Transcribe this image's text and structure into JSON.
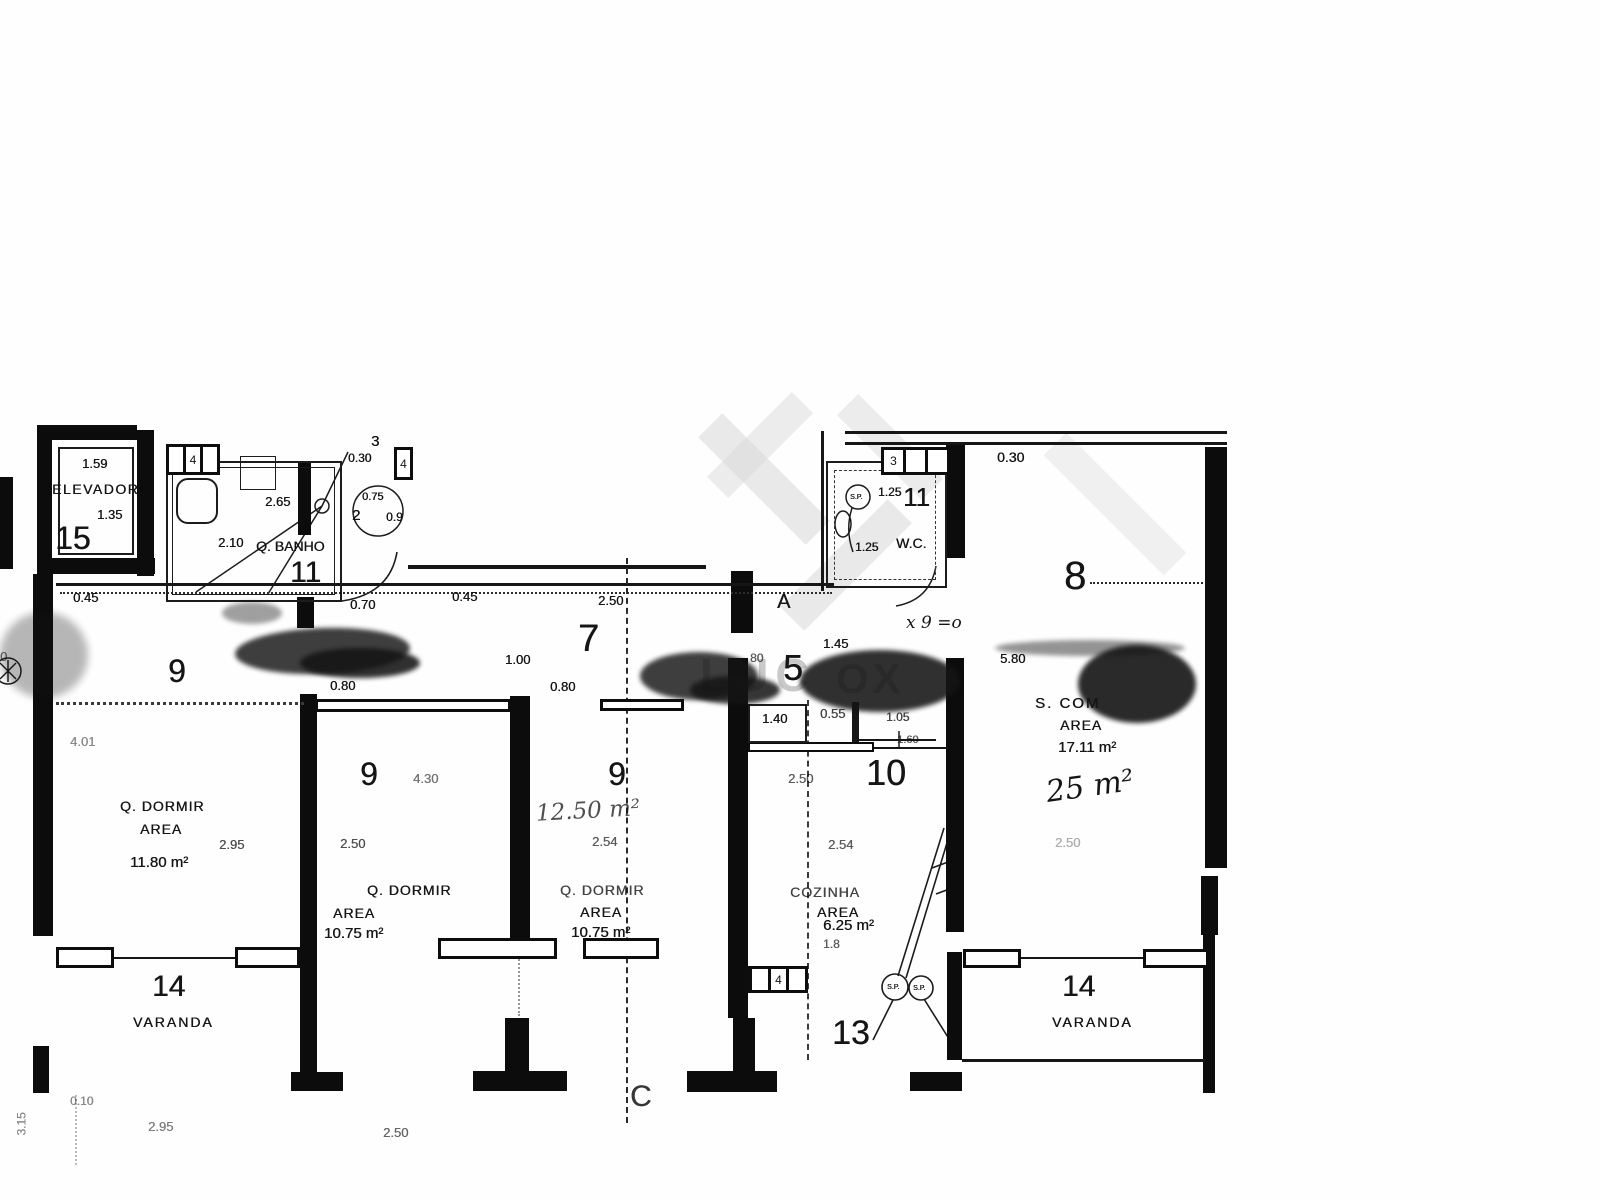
{
  "watermark": {
    "fragment_left": "LUC",
    "fragment_right": "OX"
  },
  "plan": {
    "sp_label": "S.P.",
    "edge_left_dim": "0",
    "corridor_left_dim": "0.45",
    "section_c": "C",
    "elevator": {
      "number": "15",
      "name": "ELEVADOR",
      "dim_width": "1.59",
      "dim_depth": "1.35"
    },
    "bathroom": {
      "number": "11",
      "name": "Q. BANHO",
      "dim_width": "2.65",
      "dim_depth": "2.10",
      "door_dim": "0.70",
      "tag_top": "3",
      "tag_top_dim": "0.30",
      "window_tag": "4",
      "window_tag_right": "4",
      "column_diameter": "0.75",
      "column_left": "2",
      "column_right": "0.9"
    },
    "hall7": {
      "number": "7",
      "entry": "A",
      "dim_a": "0.45",
      "dim_b": "2.50",
      "dim_c": "1.00",
      "door_dim": "0.80"
    },
    "bedroom1": {
      "number": "9",
      "name": "Q. DORMIR",
      "area_label": "AREA",
      "area": "11.80 m²",
      "dim_w": "2.95",
      "dim_h": "4.01"
    },
    "bedroom2": {
      "number": "9",
      "name": "Q. DORMIR",
      "area_label": "AREA",
      "area": "10.75 m²",
      "dim_len": "4.30",
      "dim_w": "2.50",
      "door_dim": "0.80"
    },
    "bedroom3": {
      "number": "9",
      "name": "Q. DORMIR",
      "area_label": "AREA",
      "area": "10.75 m²",
      "dim_w": "2.54",
      "handwritten_area": "12.50 m²"
    },
    "hall5": {
      "number": "5",
      "dim_a": "1.45",
      "dim_b": "80",
      "dim_c": "1.40",
      "dim_d": "0.55",
      "dim_e": "1.05",
      "dim_f": "1.60"
    },
    "room10": {
      "number": "10",
      "dim_a": "2.50",
      "dim_b": "2.54",
      "note": "x 9 =o"
    },
    "wc": {
      "number": "11",
      "name": "W.C.",
      "top_dim": "0.30",
      "dim_a": "1.25",
      "dim_b": "1.25",
      "window_tag": "3"
    },
    "living": {
      "number": "8",
      "name": "S. COM",
      "area_label": "AREA",
      "area": "17.11 m²",
      "handwritten_area": "25 m²",
      "dim_w": "5.80",
      "dim_faint": "2.50"
    },
    "kitchen": {
      "name": "COZINHA",
      "area_label": "AREA",
      "area": "6.25 m²",
      "dim_a": "1.8",
      "window_tag": "4"
    },
    "room13": {
      "number": "13"
    },
    "varanda_left": {
      "number": "14",
      "name": "VARANDA"
    },
    "varanda_right": {
      "number": "14",
      "name": "VARANDA"
    },
    "bottom_dims": {
      "a": "0.10",
      "b": "3.15",
      "c": "2.95",
      "d": "2.50"
    }
  }
}
